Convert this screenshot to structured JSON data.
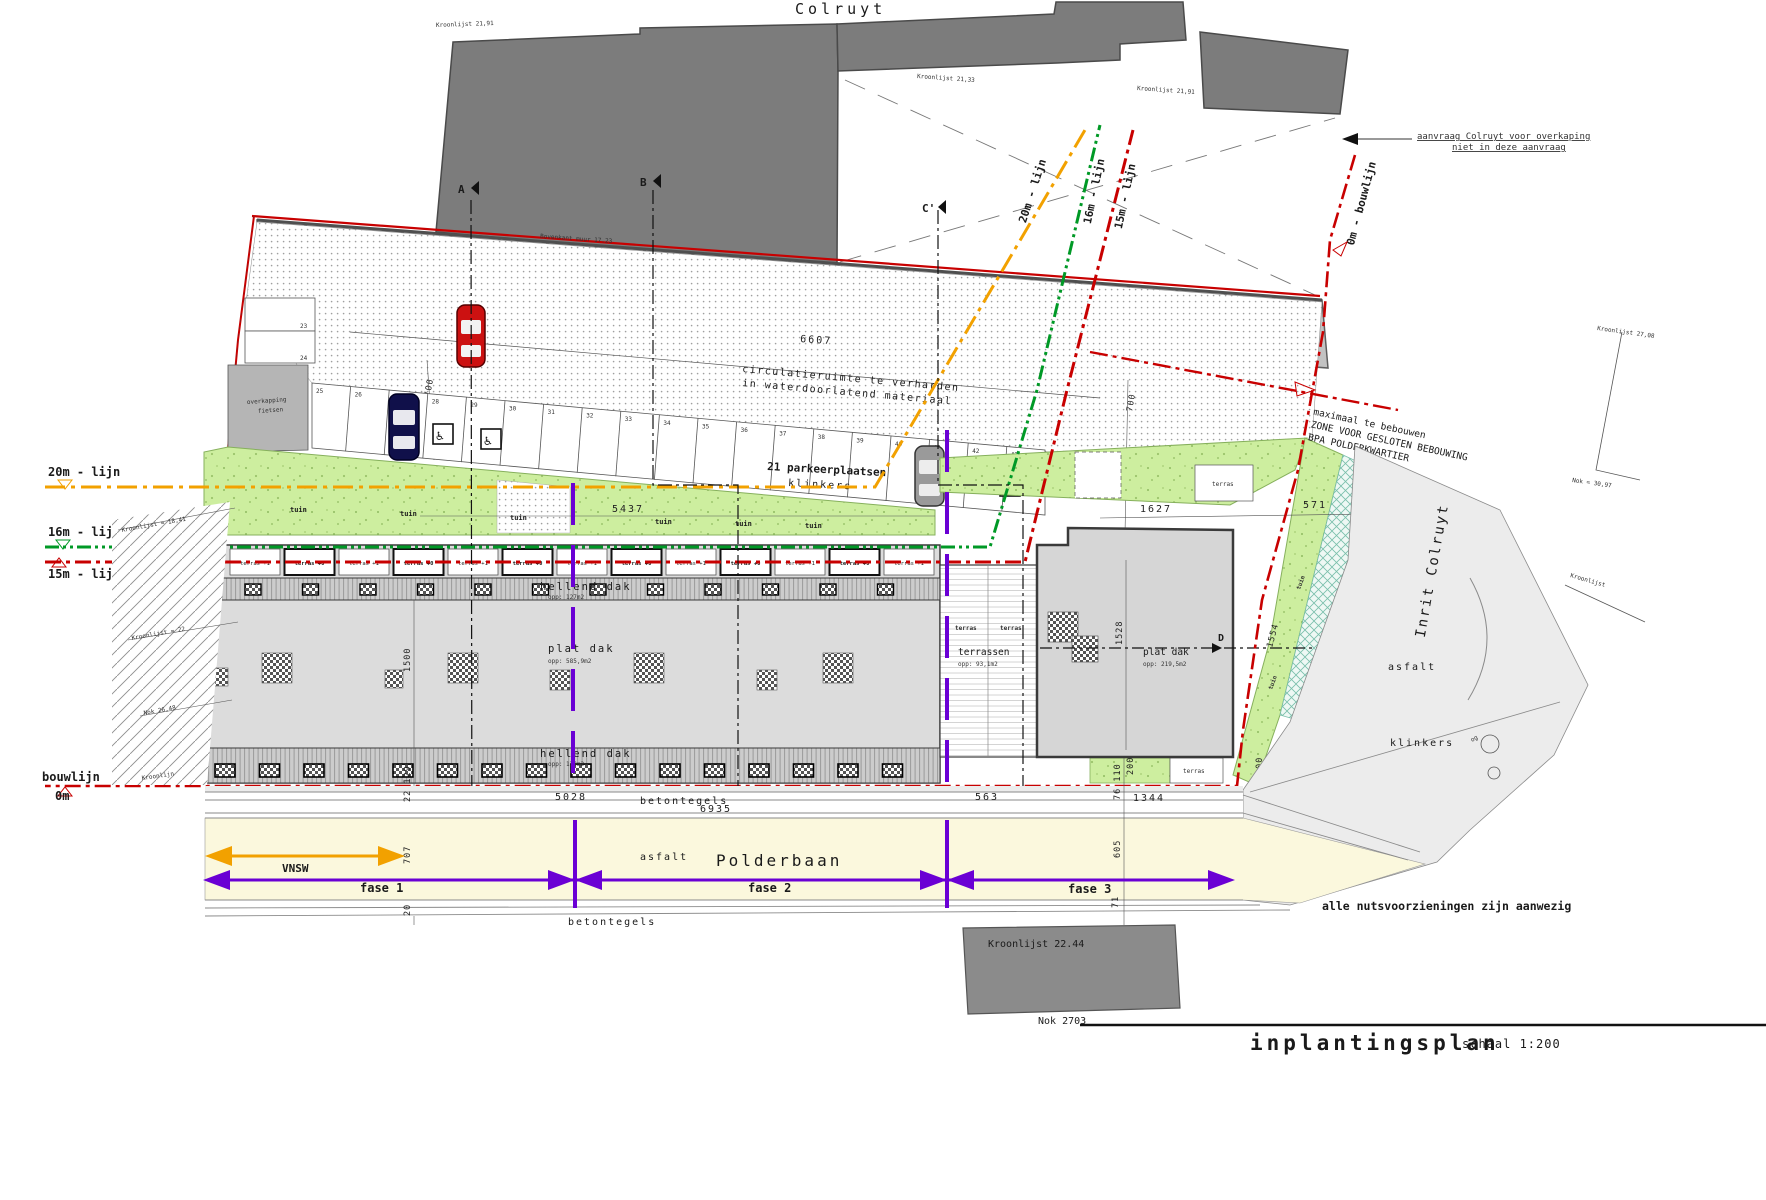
{
  "plan": {
    "title": "inplantingsplan",
    "scale": "schaal 1:200",
    "colruyt_label": "Colruyt",
    "note_overkaping_1": "aanvraag Colruyt voor overkaping",
    "note_overkaping_2": "niet in deze aanvraag",
    "note_utilities": "alle nutsvoorzieningen zijn aanwezig"
  },
  "annotations": {
    "kroonlijst_tl": "Kroonlijst 21,91",
    "kroonlijst_mid": "Kroonlijst 21,33",
    "kroonlijst_tr": "Kroonlijst 21,91",
    "kroonlijst_r1": "Kroonlijst 27,08",
    "nok_r1": "Nok = 30,97",
    "kroonlijst_r2": "Kroonlijst",
    "bovenkant_muur": "Bovenkant muur 17.23",
    "kroonlijst_l1": "Kroonlijst ≈ 18,41",
    "kroonlijst_l2": "Kroonlijst ≈ 22",
    "nok_l": "Nok 26,48",
    "kroonlijn_l": "Kroonlijn",
    "kroonlijst_bottom": "Kroonlijst 22.44",
    "nok_bottom": "Nok 2703",
    "zone_1": "maximaal te bebouwen",
    "zone_2": "ZONE VOOR GESLOTEN BEBOUWING",
    "zone_3": "BPA POLDERKWARTIER",
    "inrit": "Inrit Colruyt",
    "asfalt_inrit": "asfalt",
    "klinkers_inrit": "klinkers",
    "og": "og"
  },
  "lines": {
    "l20": "20m - lijn",
    "l16": "16m - lijn",
    "l15": "15m - lijn",
    "bouwlijn": "bouwlijn",
    "m0": "0m",
    "bouwlijn_right": "0m - bouwlijn",
    "colors": {
      "l20": "#f2a100",
      "l16": "#009926",
      "l15": "#c80000",
      "fase": "#6a00d4"
    }
  },
  "site": {
    "garages_label": "22 garageboxen",
    "garages_dim": "6607",
    "circulation_1": "circulatieruimte te verharden",
    "circulation_2": "in waterdoorlatend materiaal",
    "parking_label": "21 parkeerplaatsen",
    "parking_surface": "klinkers",
    "garden_dim": "5437",
    "tuin": "tuin",
    "overkapping_1": "overkapping",
    "overkapping_2": "fietsen",
    "terras_1": "terras +1",
    "terras_0": "terras +0",
    "parking_numbers": [
      "23",
      "24",
      "25",
      "26",
      "27",
      "28",
      "29",
      "30",
      "31",
      "32",
      "33",
      "34",
      "35",
      "36",
      "37",
      "38",
      "39",
      "40",
      "41",
      "42",
      "43"
    ]
  },
  "buildings": {
    "hellend_label": "hellend dak",
    "hellend_top_opp": "opp: 127m2",
    "plat_label": "plat dak",
    "plat_opp": "opp: 585,9m2",
    "hellend_bottom_opp": "opp: 130m2",
    "terrassen_label": "terrassen",
    "terrassen_opp": "opp: 93,1m2",
    "plat_right_label": "plat dak",
    "plat_right_opp": "opp: 219,5m2",
    "terras_small": "terras"
  },
  "road": {
    "name": "Polderbaan",
    "surface": "asfalt",
    "sidewalk_top": "betontegels",
    "sidewalk_bottom": "betontegels",
    "vnsw": "VNSW",
    "fase1": "fase 1",
    "fase2": "fase 2",
    "fase3": "fase 3"
  },
  "dims": {
    "d550a": "550",
    "d550b": "550",
    "d700a": "700",
    "d700b": "700",
    "d450": "450",
    "d435": "435",
    "d228": "228",
    "d1627": "1627",
    "d251": "251",
    "d190": "190",
    "d571": "571",
    "d26": "26",
    "d894": "894",
    "d1528": "1528",
    "d1554": "1554",
    "d200a": "200",
    "d200b": "200",
    "d1500": "1500",
    "d22129": "22 129",
    "d707": "707",
    "d20": "20",
    "d5028": "5028",
    "d6935": "6935",
    "d563": "563",
    "d1344": "1344",
    "d76110": "76 110",
    "d605": "605",
    "d71": "71"
  },
  "sections": {
    "a": "A",
    "a1": "A'",
    "b": "B",
    "b1": "B'",
    "c": "C",
    "c1": "C'",
    "d": "D"
  }
}
